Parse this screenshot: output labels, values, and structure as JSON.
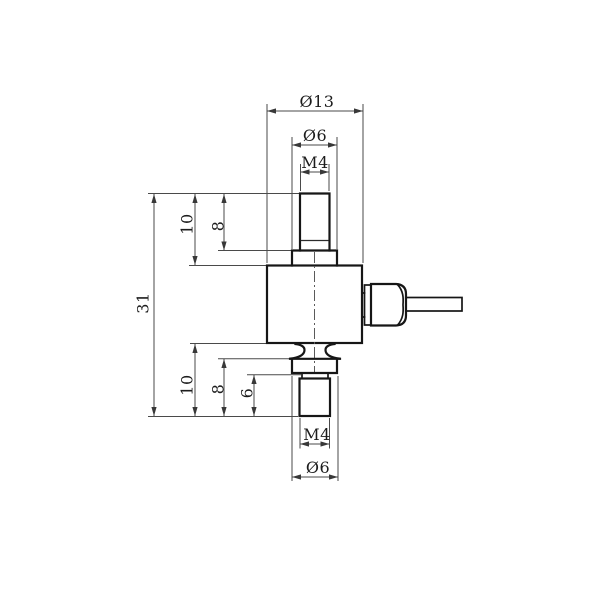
{
  "drawing": {
    "type": "engineering-dimension-drawing",
    "subject": "miniature tension-compression load cell with threaded studs and side cable gland",
    "background": "#ffffff",
    "colors": {
      "part_outline": "#161616",
      "dimension_lines": "#4a4a4a",
      "text": "#1c1c1c"
    },
    "dims": {
      "dia_body": "Ø13",
      "dia_boss_top": "Ø6",
      "thread_top": "M4",
      "height_total": "31",
      "protrusion_top": "10",
      "thread_len_top": "8",
      "protrusion_bottom": "10",
      "boss_to_end_bottom": "8",
      "thread_len_bottom": "6",
      "thread_bottom": "M4",
      "dia_boss_bottom": "Ø6"
    }
  }
}
